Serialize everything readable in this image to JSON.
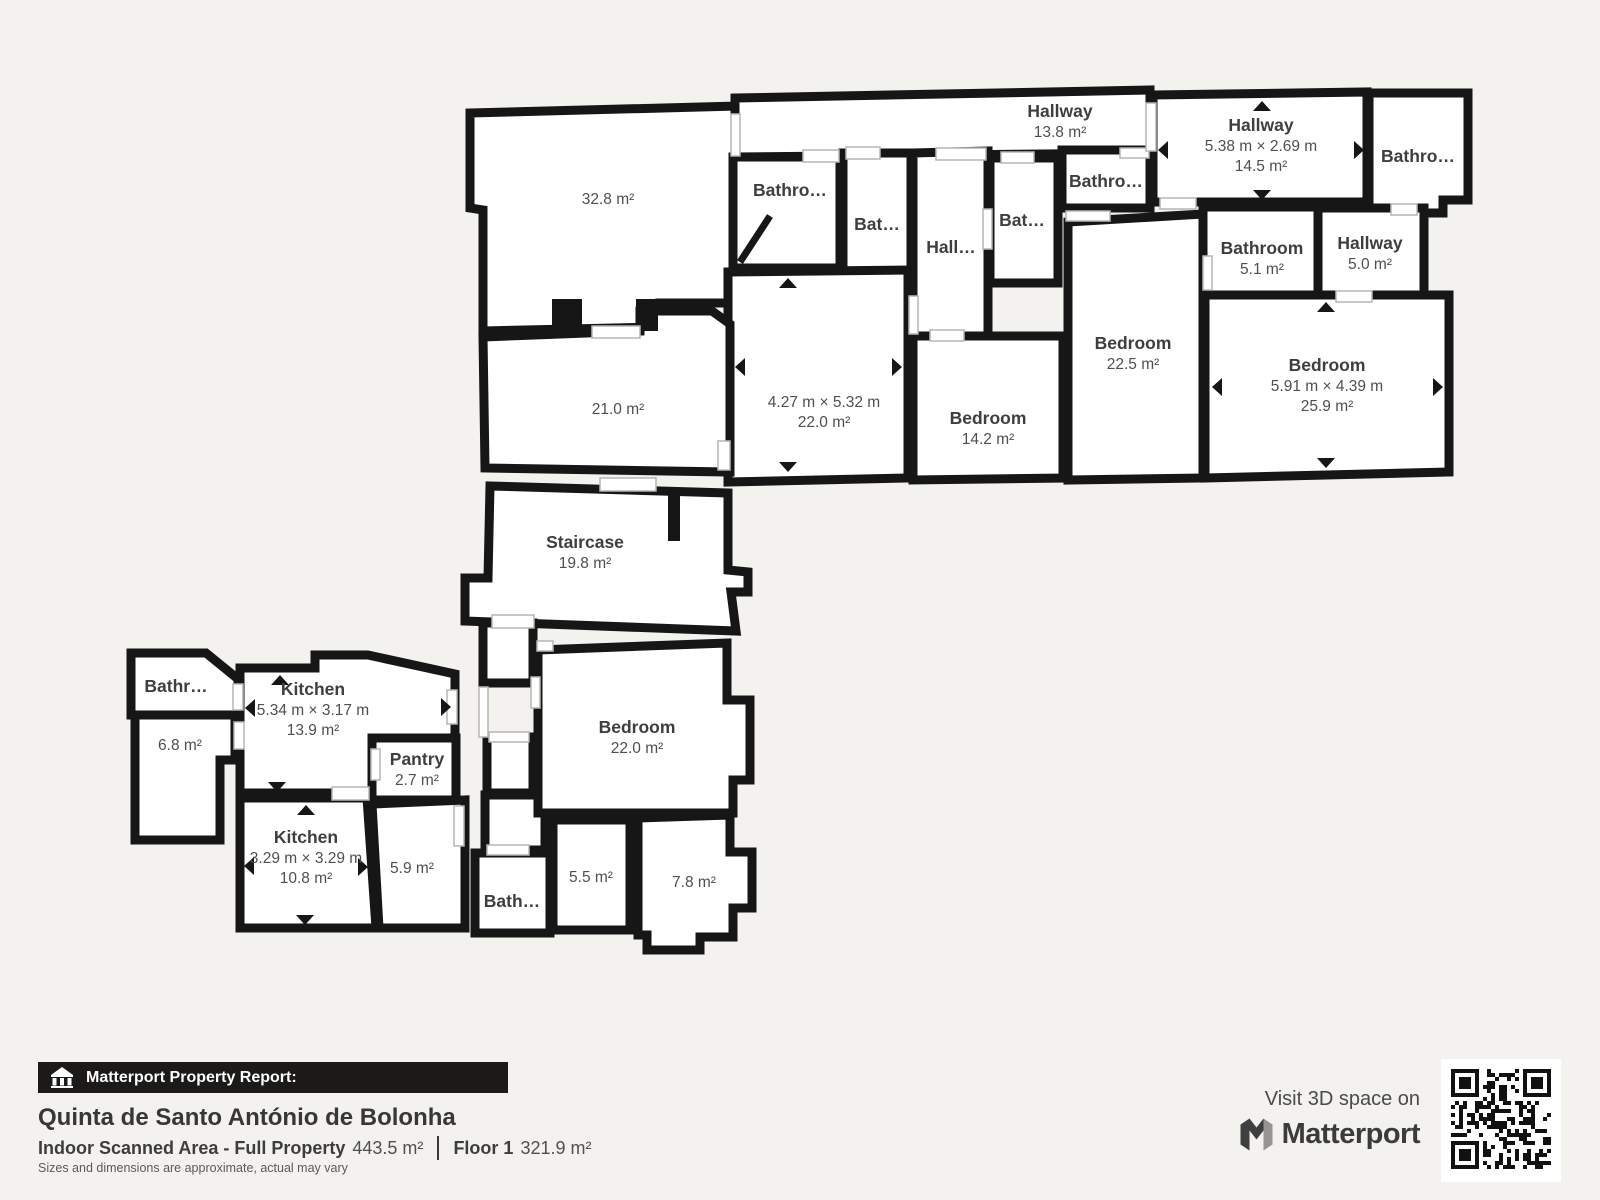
{
  "footer": {
    "report_label": "Matterport Property Report:",
    "property_name": "Quinta de Santo António de Bolonha",
    "scanned_area_label": "Indoor Scanned Area - Full Property",
    "scanned_area_value": "443.5 m²",
    "floor_label": "Floor 1",
    "floor_value": "321.9 m²",
    "disclaimer": "Sizes and dimensions are approximate, actual may vary",
    "visit_label": "Visit 3D space on",
    "brand_name": "Matterport"
  },
  "colors": {
    "background": "#f3f2ef",
    "wall": "#161616",
    "room_fill": "#ffffff",
    "label_text": "#3e3e3e",
    "sub_text": "#4f4f4f",
    "bar_background": "#1b1a19"
  },
  "icons": [
    "building-icon",
    "matterport-logo-icon",
    "qr-code"
  ],
  "floorplan": {
    "rooms": [
      {
        "id": "room-32-8",
        "area": "32.8 m²",
        "label": [
          608,
          198
        ],
        "poly": [
          [
            470,
            113
          ],
          [
            738,
            106
          ],
          [
            738,
            303
          ],
          [
            660,
            303
          ],
          [
            660,
            327
          ],
          [
            483,
            331
          ],
          [
            483,
            210
          ],
          [
            470,
            208
          ]
        ]
      },
      {
        "id": "hallway-13-8",
        "name": "Hallway",
        "area": "13.8 m²",
        "label": [
          1060,
          111
        ],
        "poly": [
          [
            735,
            98
          ],
          [
            1150,
            90
          ],
          [
            1150,
            153
          ],
          [
            735,
            157
          ]
        ]
      },
      {
        "id": "bathroom-top-a",
        "name": "Bathro…",
        "label": [
          790,
          190
        ],
        "poly": [
          [
            733,
            157
          ],
          [
            840,
            157
          ],
          [
            840,
            268
          ],
          [
            733,
            268
          ]
        ]
      },
      {
        "id": "bathroom-top-b",
        "name": "Bat…",
        "label": [
          877,
          224
        ],
        "poly": [
          [
            843,
            153
          ],
          [
            911,
            153
          ],
          [
            911,
            293
          ],
          [
            843,
            293
          ]
        ]
      },
      {
        "id": "hall-corridor",
        "name": "Hall…",
        "label": [
          951,
          247
        ],
        "poly": [
          [
            913,
            153
          ],
          [
            988,
            151
          ],
          [
            988,
            338
          ],
          [
            913,
            338
          ]
        ]
      },
      {
        "id": "bathroom-top-c",
        "name": "Bat…",
        "label": [
          1022,
          220
        ],
        "poly": [
          [
            990,
            158
          ],
          [
            1058,
            158
          ],
          [
            1058,
            283
          ],
          [
            990,
            283
          ]
        ]
      },
      {
        "id": "bathroom-top-d",
        "name": "Bathro…",
        "label": [
          1106,
          181
        ],
        "poly": [
          [
            1062,
            150
          ],
          [
            1150,
            150
          ],
          [
            1150,
            208
          ],
          [
            1062,
            208
          ]
        ]
      },
      {
        "id": "hallway-14-5",
        "name": "Hallway",
        "dims": "5.38 m × 2.69 m",
        "area": "14.5 m²",
        "label": [
          1261,
          125
        ],
        "poly": [
          [
            1153,
            95
          ],
          [
            1367,
            92
          ],
          [
            1367,
            202
          ],
          [
            1153,
            202
          ]
        ],
        "arrows": [
          {
            "d": "up",
            "x": 1262,
            "y": 107
          },
          {
            "d": "down",
            "x": 1262,
            "y": 194
          },
          {
            "d": "left",
            "x": 1164,
            "y": 150
          },
          {
            "d": "right",
            "x": 1358,
            "y": 150
          }
        ]
      },
      {
        "id": "bathroom-top-right",
        "name": "Bathro…",
        "label": [
          1418,
          156
        ],
        "poly": [
          [
            1369,
            93
          ],
          [
            1468,
            93
          ],
          [
            1468,
            200
          ],
          [
            1443,
            200
          ],
          [
            1443,
            213
          ],
          [
            1369,
            213
          ]
        ]
      },
      {
        "id": "bathroom-5-1",
        "name": "Bathroom",
        "area": "5.1 m²",
        "label": [
          1262,
          248
        ],
        "poly": [
          [
            1203,
            207
          ],
          [
            1320,
            207
          ],
          [
            1320,
            297
          ],
          [
            1203,
            297
          ]
        ]
      },
      {
        "id": "hallway-5-0",
        "name": "Hallway",
        "area": "5.0 m²",
        "label": [
          1370,
          243
        ],
        "poly": [
          [
            1318,
            208
          ],
          [
            1424,
            208
          ],
          [
            1424,
            297
          ],
          [
            1318,
            297
          ]
        ]
      },
      {
        "id": "bedroom-22-5",
        "name": "Bedroom",
        "area": "22.5 m²",
        "label": [
          1133,
          343
        ],
        "poly": [
          [
            1068,
            222
          ],
          [
            1203,
            214
          ],
          [
            1203,
            478
          ],
          [
            1068,
            480
          ]
        ]
      },
      {
        "id": "room-dim-22-0",
        "dims": "4.27 m × 5.32 m",
        "area": "22.0 m²",
        "label": [
          824,
          401
        ],
        "poly": [
          [
            728,
            272
          ],
          [
            908,
            270
          ],
          [
            908,
            478
          ],
          [
            728,
            482
          ]
        ],
        "arrows": [
          {
            "d": "up",
            "x": 788,
            "y": 284
          },
          {
            "d": "down",
            "x": 788,
            "y": 466
          },
          {
            "d": "left",
            "x": 741,
            "y": 367
          },
          {
            "d": "right",
            "x": 896,
            "y": 367
          }
        ]
      },
      {
        "id": "bedroom-14-2",
        "name": "Bedroom",
        "area": "14.2 m²",
        "label": [
          988,
          418
        ],
        "poly": [
          [
            913,
            336
          ],
          [
            1063,
            336
          ],
          [
            1063,
            478
          ],
          [
            913,
            480
          ]
        ]
      },
      {
        "id": "bedroom-25-9",
        "name": "Bedroom",
        "dims": "5.91 m × 4.39 m",
        "area": "25.9 m²",
        "label": [
          1327,
          365
        ],
        "poly": [
          [
            1205,
            295
          ],
          [
            1449,
            295
          ],
          [
            1449,
            472
          ],
          [
            1205,
            478
          ]
        ],
        "arrows": [
          {
            "d": "up",
            "x": 1326,
            "y": 308
          },
          {
            "d": "down",
            "x": 1326,
            "y": 462
          },
          {
            "d": "left",
            "x": 1218,
            "y": 387
          },
          {
            "d": "right",
            "x": 1437,
            "y": 387
          }
        ]
      },
      {
        "id": "room-21-0",
        "area": "21.0 m²",
        "label": [
          618,
          408
        ],
        "poly": [
          [
            483,
            337
          ],
          [
            640,
            331
          ],
          [
            640,
            311
          ],
          [
            712,
            311
          ],
          [
            730,
            324
          ],
          [
            730,
            472
          ],
          [
            485,
            468
          ]
        ]
      },
      {
        "id": "staircase",
        "name": "Staircase",
        "area": "19.8 m²",
        "label": [
          585,
          542
        ],
        "poly": [
          [
            490,
            486
          ],
          [
            728,
            493
          ],
          [
            728,
            570
          ],
          [
            748,
            572
          ],
          [
            748,
            592
          ],
          [
            731,
            592
          ],
          [
            736,
            631
          ],
          [
            465,
            621
          ],
          [
            465,
            578
          ],
          [
            488,
            578
          ]
        ]
      },
      {
        "id": "vestibule-a",
        "poly": [
          [
            483,
            623
          ],
          [
            533,
            623
          ],
          [
            533,
            683
          ],
          [
            483,
            683
          ]
        ]
      },
      {
        "id": "vestibule-b",
        "poly": [
          [
            487,
            737
          ],
          [
            533,
            737
          ],
          [
            533,
            793
          ],
          [
            487,
            793
          ]
        ]
      },
      {
        "id": "vestibule-c",
        "poly": [
          [
            485,
            795
          ],
          [
            545,
            795
          ],
          [
            545,
            850
          ],
          [
            485,
            850
          ]
        ]
      },
      {
        "id": "bathroom-small-left",
        "name": "Bathr…",
        "label": [
          176,
          686
        ],
        "poly": [
          [
            131,
            653
          ],
          [
            206,
            653
          ],
          [
            238,
            679
          ],
          [
            238,
            715
          ],
          [
            131,
            715
          ]
        ]
      },
      {
        "id": "room-6-8",
        "area": "6.8 m²",
        "label": [
          180,
          744
        ],
        "poly": [
          [
            135,
            715
          ],
          [
            235,
            715
          ],
          [
            235,
            760
          ],
          [
            220,
            760
          ],
          [
            220,
            840
          ],
          [
            135,
            840
          ]
        ]
      },
      {
        "id": "kitchen-13-9",
        "name": "Kitchen",
        "dims": "5.34 m × 3.17 m",
        "area": "13.9 m²",
        "label": [
          313,
          689
        ],
        "poly": [
          [
            240,
            668
          ],
          [
            315,
            668
          ],
          [
            315,
            655
          ],
          [
            368,
            655
          ],
          [
            455,
            674
          ],
          [
            455,
            738
          ],
          [
            372,
            738
          ],
          [
            372,
            793
          ],
          [
            240,
            793
          ]
        ],
        "arrows": [
          {
            "d": "up",
            "x": 280,
            "y": 681
          },
          {
            "d": "down",
            "x": 277,
            "y": 786
          },
          {
            "d": "left",
            "x": 251,
            "y": 708
          },
          {
            "d": "right",
            "x": 445,
            "y": 707
          }
        ]
      },
      {
        "id": "pantry",
        "name": "Pantry",
        "area": "2.7 m²",
        "label": [
          417,
          759
        ],
        "poly": [
          [
            372,
            738
          ],
          [
            456,
            738
          ],
          [
            456,
            800
          ],
          [
            372,
            800
          ]
        ]
      },
      {
        "id": "kitchen-10-8",
        "name": "Kitchen",
        "dims": "3.29 m × 3.29 m",
        "area": "10.8 m²",
        "label": [
          306,
          837
        ],
        "poly": [
          [
            240,
            798
          ],
          [
            367,
            798
          ],
          [
            376,
            928
          ],
          [
            240,
            928
          ]
        ],
        "arrows": [
          {
            "d": "up",
            "x": 306,
            "y": 811
          },
          {
            "d": "down",
            "x": 305,
            "y": 919
          },
          {
            "d": "left",
            "x": 250,
            "y": 866
          },
          {
            "d": "right",
            "x": 362,
            "y": 867
          }
        ]
      },
      {
        "id": "room-5-9",
        "area": "5.9 m²",
        "label": [
          412,
          867
        ],
        "poly": [
          [
            372,
            804
          ],
          [
            465,
            800
          ],
          [
            465,
            928
          ],
          [
            379,
            928
          ]
        ]
      },
      {
        "id": "bedroom-22-0",
        "name": "Bedroom",
        "area": "22.0 m²",
        "label": [
          637,
          727
        ],
        "poly": [
          [
            538,
            650
          ],
          [
            727,
            643
          ],
          [
            727,
            700
          ],
          [
            750,
            700
          ],
          [
            750,
            780
          ],
          [
            733,
            780
          ],
          [
            733,
            813
          ],
          [
            538,
            813
          ]
        ]
      },
      {
        "id": "bathroom-bottom",
        "name": "Bath…",
        "label": [
          512,
          901
        ],
        "poly": [
          [
            475,
            853
          ],
          [
            550,
            853
          ],
          [
            550,
            933
          ],
          [
            475,
            933
          ]
        ]
      },
      {
        "id": "room-5-5",
        "area": "5.5 m²",
        "label": [
          591,
          876
        ],
        "poly": [
          [
            553,
            820
          ],
          [
            630,
            820
          ],
          [
            630,
            930
          ],
          [
            553,
            930
          ]
        ]
      },
      {
        "id": "room-7-8",
        "area": "7.8 m²",
        "label": [
          694,
          881
        ],
        "poly": [
          [
            638,
            818
          ],
          [
            730,
            815
          ],
          [
            730,
            852
          ],
          [
            752,
            852
          ],
          [
            752,
            908
          ],
          [
            733,
            908
          ],
          [
            733,
            937
          ],
          [
            700,
            937
          ],
          [
            700,
            950
          ],
          [
            647,
            950
          ],
          [
            647,
            935
          ],
          [
            638,
            935
          ]
        ]
      }
    ],
    "doors": [
      [
        803,
        150,
        36,
        12
      ],
      [
        846,
        147,
        34,
        12
      ],
      [
        936,
        148,
        50,
        12
      ],
      [
        1001,
        152,
        33,
        11
      ],
      [
        1120,
        148,
        29,
        10
      ],
      [
        731,
        114,
        9,
        42
      ],
      [
        1146,
        103,
        10,
        48
      ],
      [
        1160,
        198,
        36,
        11
      ],
      [
        1066,
        211,
        44,
        10
      ],
      [
        1203,
        256,
        9,
        34
      ],
      [
        1336,
        291,
        36,
        11
      ],
      [
        1391,
        204,
        26,
        11
      ],
      [
        930,
        330,
        34,
        11
      ],
      [
        983,
        209,
        9,
        40
      ],
      [
        909,
        296,
        9,
        38
      ],
      [
        592,
        326,
        48,
        12
      ],
      [
        718,
        441,
        12,
        29
      ],
      [
        600,
        478,
        56,
        13
      ],
      [
        492,
        615,
        42,
        13
      ],
      [
        447,
        690,
        10,
        34
      ],
      [
        233,
        684,
        10,
        26
      ],
      [
        234,
        722,
        10,
        27
      ],
      [
        371,
        749,
        9,
        31
      ],
      [
        332,
        787,
        37,
        13
      ],
      [
        479,
        687,
        9,
        50
      ],
      [
        531,
        677,
        9,
        31
      ],
      [
        489,
        732,
        40,
        10
      ],
      [
        487,
        845,
        42,
        10
      ],
      [
        454,
        806,
        10,
        40
      ],
      [
        537,
        641,
        16,
        10
      ]
    ],
    "stubs": [
      [
        552,
        299,
        30,
        34
      ],
      [
        636,
        299,
        22,
        32
      ],
      [
        668,
        493,
        12,
        48
      ]
    ],
    "door_leaves": [
      [
        740,
        262,
        770,
        216
      ]
    ]
  }
}
